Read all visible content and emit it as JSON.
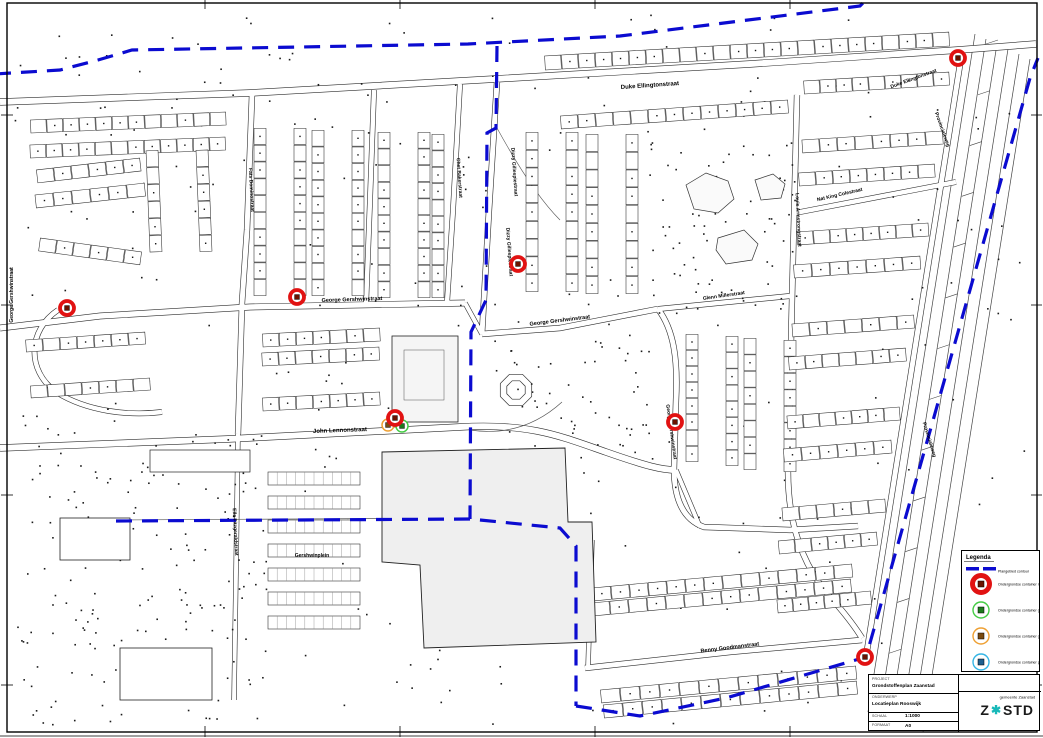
{
  "sheet": {
    "type": "locatiekaart",
    "background": "#ffffff",
    "frame_color": "#000000"
  },
  "legend": {
    "title": "Legenda",
    "items": [
      {
        "type": "boundary",
        "label": "Plangebied contour",
        "color": "#0b0bd0"
      },
      {
        "type": "rest",
        "label": "Ondergrondse container restafval",
        "ring": "#e11212",
        "center": "#6b1200"
      },
      {
        "type": "glas",
        "label": "Ondergrondse container glas",
        "ring": "#44cc44",
        "center": "#1c7a1c"
      },
      {
        "type": "gft",
        "label": "Ondergrondse container gft",
        "ring": "#eea033",
        "center": "#7a4a10"
      },
      {
        "type": "papier",
        "label": "Ondergrondse container papier",
        "ring": "#35b5e5",
        "center": "#1f5f8f"
      }
    ]
  },
  "titleblock": {
    "project_label": "PROJECT",
    "project": "Grondstoffenplan Zaanstad",
    "subject_label": "ONDERWERP",
    "subject": "Locatieplan Rooswijk",
    "scale_label": "SCHAAL",
    "scale": "1:1000",
    "format_label": "FORMAAT",
    "format": "A0",
    "municipality": "gemeente Zaanstad",
    "logo_z": "Z",
    "logo_mark": "✱",
    "logo_rest": "STD",
    "logo_color": "#1a1a1a",
    "emblem_color": "#17b8b8"
  },
  "map": {
    "boundary_color": "#0b0bd0",
    "boundary_paths": [
      "M-5,74 L60,70 L98,60 L132,50 L300,47 L468,44 L620,36 L860,6 L868,-2",
      "M497,46 L496,128 L487,133 L486,300 L471,332 L470,519",
      "M116,521 L470,519 L560,528 L576,546 L576,706",
      "M576,706 L640,716 L726,698 L866,657 L1030,78 L1038,58"
    ],
    "street_labels": [
      {
        "text": "Duke Ellingtonstraat",
        "x": 650,
        "y": 87,
        "rot": -4,
        "size": 6
      },
      {
        "text": "Duke Ellingtonstraat",
        "x": 914,
        "y": 80,
        "rot": -20,
        "size": 5
      },
      {
        "text": "Chet Bakerstraat",
        "x": 458,
        "y": 178,
        "rot": 86,
        "size": 5
      },
      {
        "text": "Dizzy Gillespiestraat",
        "x": 513,
        "y": 172,
        "rot": 86,
        "size": 5
      },
      {
        "text": "Dizzy Gillespiestraat",
        "x": 508,
        "y": 252,
        "rot": 86,
        "size": 5
      },
      {
        "text": "George Gershwinstraat",
        "x": 352,
        "y": 301,
        "rot": -2,
        "size": 5.5
      },
      {
        "text": "George Gershwinstraat",
        "x": 560,
        "y": 322,
        "rot": -7,
        "size": 5.5
      },
      {
        "text": "George Gershwinstraat",
        "x": 670,
        "y": 432,
        "rot": 82,
        "size": 5
      },
      {
        "text": "George Gershwinstraat",
        "x": 13,
        "y": 295,
        "rot": -90,
        "size": 5
      },
      {
        "text": "John Lennonstraat",
        "x": 340,
        "y": 432,
        "rot": -2,
        "size": 6
      },
      {
        "text": "Glenn Millerstraat",
        "x": 724,
        "y": 297,
        "rot": -8,
        "size": 5
      },
      {
        "text": "Nat King Colestraat",
        "x": 840,
        "y": 196,
        "rot": -13,
        "size": 5
      },
      {
        "text": "Louis Armstrongstraat",
        "x": 797,
        "y": 220,
        "rot": 87,
        "size": 5
      },
      {
        "text": "Benny Goodmanstraat",
        "x": 730,
        "y": 649,
        "rot": -7,
        "size": 5.5
      },
      {
        "text": "Provincialeweg",
        "x": 941,
        "y": 130,
        "rot": 70,
        "size": 5
      },
      {
        "text": "Provincialeweg",
        "x": 928,
        "y": 440,
        "rot": 73,
        "size": 5
      },
      {
        "text": "Ella Fitzgeraldstraat",
        "x": 234,
        "y": 532,
        "rot": 87,
        "size": 5
      },
      {
        "text": "Fats Dominostraat",
        "x": 250,
        "y": 190,
        "rot": 87,
        "size": 5
      },
      {
        "text": "Gershwinplein",
        "x": 312,
        "y": 557,
        "rot": 0,
        "size": 5
      }
    ],
    "markers": [
      {
        "type": "gft",
        "x": 388,
        "y": 425
      },
      {
        "type": "glas",
        "x": 402,
        "y": 426
      },
      {
        "type": "rest",
        "x": 395,
        "y": 418
      },
      {
        "type": "rest",
        "x": 67,
        "y": 308
      },
      {
        "type": "rest",
        "x": 297,
        "y": 297
      },
      {
        "type": "rest",
        "x": 518,
        "y": 264
      },
      {
        "type": "rest",
        "x": 675,
        "y": 422
      },
      {
        "type": "rest",
        "x": 865,
        "y": 657
      },
      {
        "type": "rest",
        "x": 958,
        "y": 58
      }
    ]
  }
}
